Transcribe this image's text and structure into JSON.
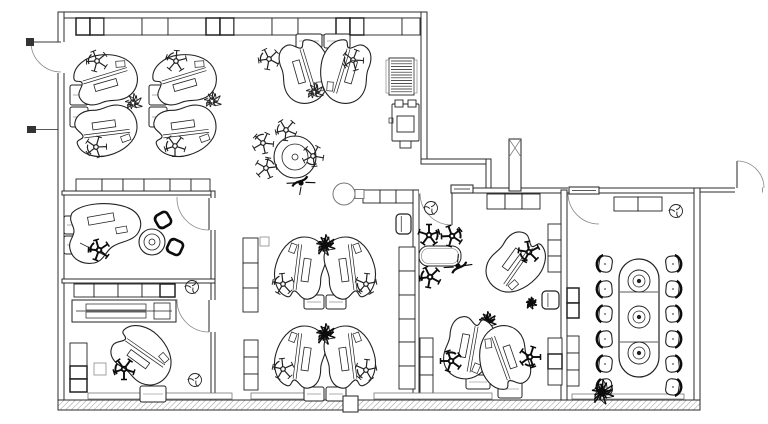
{
  "meta": {
    "width": 768,
    "height": 424,
    "bg": "#ffffff",
    "ink": "#2b2b2b",
    "furn": "#222222",
    "dark": "#0c0c0c",
    "light": "#777777"
  },
  "plan": {
    "walls": [
      {
        "x": 60,
        "y": 12,
        "w": 367,
        "h": 6
      },
      {
        "x": 58,
        "y": 12,
        "w": 6,
        "h": 398
      },
      {
        "x": 421,
        "y": 12,
        "w": 6,
        "h": 152
      },
      {
        "x": 421,
        "y": 159,
        "w": 70,
        "h": 5
      },
      {
        "x": 486,
        "y": 159,
        "w": 5,
        "h": 33
      },
      {
        "x": 449,
        "y": 188,
        "w": 251,
        "h": 5
      },
      {
        "x": 413,
        "y": 190,
        "w": 6,
        "h": 212
      },
      {
        "x": 561,
        "y": 190,
        "w": 6,
        "h": 212
      },
      {
        "x": 694,
        "y": 188,
        "w": 6,
        "h": 222
      },
      {
        "x": 58,
        "y": 400,
        "w": 642,
        "h": 10,
        "hatch": true
      },
      {
        "x": 62,
        "y": 191,
        "w": 153,
        "h": 4
      },
      {
        "x": 211,
        "y": 191,
        "w": 4,
        "h": 209
      },
      {
        "x": 62,
        "y": 279,
        "w": 153,
        "h": 4
      },
      {
        "x": 700,
        "y": 188,
        "w": 62,
        "h": 4
      }
    ],
    "gaps": [
      {
        "x": 57,
        "y": 42,
        "w": 8,
        "h": 31
      },
      {
        "x": 210,
        "y": 198,
        "w": 6,
        "h": 32
      },
      {
        "x": 210,
        "y": 300,
        "w": 6,
        "h": 32
      },
      {
        "x": 419,
        "y": 187,
        "w": 33,
        "h": 7
      },
      {
        "x": 568,
        "y": 187,
        "w": 31,
        "h": 7
      },
      {
        "x": 735,
        "y": 187,
        "w": 27,
        "h": 6
      }
    ],
    "cabinets_h": [
      {
        "x": 76,
        "y": 18,
        "h": 17,
        "w": [
          14,
          14,
          38,
          26,
          38,
          14,
          14,
          38,
          26,
          38,
          14,
          14,
          38,
          18
        ]
      },
      {
        "x": 76,
        "y": 179,
        "h": 12,
        "w": [
          26,
          21,
          21,
          26,
          21,
          19
        ]
      },
      {
        "x": 74,
        "y": 284,
        "h": 13,
        "w": [
          20,
          24,
          24,
          18,
          15
        ]
      },
      {
        "x": 363,
        "y": 190,
        "h": 13,
        "w": [
          17,
          16,
          17
        ]
      },
      {
        "x": 487,
        "y": 194,
        "h": 15,
        "w": [
          18,
          17,
          18
        ]
      },
      {
        "x": 614,
        "y": 197,
        "h": 14,
        "w": [
          24,
          24
        ]
      }
    ],
    "cabinets_v": [
      {
        "x": 243,
        "y": 238,
        "w": 15,
        "h": [
          25,
          25,
          24
        ]
      },
      {
        "x": 244,
        "y": 340,
        "w": 14,
        "h": [
          17,
          17,
          16
        ]
      },
      {
        "x": 399,
        "y": 247,
        "w": 16,
        "h": [
          24,
          24,
          24,
          23,
          24,
          23
        ]
      },
      {
        "x": 420,
        "y": 338,
        "w": 13,
        "h": [
          19,
          18,
          19
        ]
      },
      {
        "x": 548,
        "y": 224,
        "w": 13,
        "h": [
          16,
          16,
          16
        ]
      },
      {
        "x": 548,
        "y": 338,
        "w": 14,
        "h": [
          16,
          15,
          16
        ]
      },
      {
        "x": 567,
        "y": 288,
        "w": 12,
        "h": [
          15,
          15
        ]
      },
      {
        "x": 567,
        "y": 336,
        "w": 12,
        "h": [
          17,
          17,
          16
        ]
      },
      {
        "x": 70,
        "y": 343,
        "w": 17,
        "h": [
          23,
          13,
          13
        ]
      }
    ],
    "sills": [
      {
        "x": 88,
        "y": 393,
        "w": 144,
        "h": 6
      },
      {
        "x": 251,
        "y": 393,
        "w": 66,
        "h": 6
      },
      {
        "x": 374,
        "y": 393,
        "w": 118,
        "h": 6
      },
      {
        "x": 572,
        "y": 394,
        "w": 112,
        "h": 5
      }
    ],
    "doors": [
      {
        "hx": 61,
        "hy": 42,
        "r": 30,
        "a0": 180,
        "a1": 90,
        "cap": [
          26,
          38,
          8,
          8
        ]
      },
      {
        "hx": 209,
        "hy": 198,
        "r": 32,
        "a0": 90,
        "a1": 182
      },
      {
        "hx": 209,
        "hy": 300,
        "r": 32,
        "a0": 90,
        "a1": 182
      },
      {
        "hx": 452,
        "hy": 193,
        "r": 32,
        "a0": 90,
        "a1": 180,
        "crect": [
          451,
          185,
          22,
          8
        ]
      },
      {
        "hx": 599,
        "hy": 193,
        "r": 31,
        "a0": 180,
        "a1": 90,
        "crect": [
          569,
          187,
          30,
          7
        ]
      },
      {
        "hx": 737,
        "hy": 188,
        "r": 27,
        "a0": 270,
        "a1": 360
      }
    ],
    "items": [
      {
        "t": "column",
        "x": 509,
        "y": 139,
        "w": 12,
        "h": 52,
        "xx": true
      },
      {
        "t": "ped",
        "x": 70,
        "y": 85,
        "w": 18,
        "h": 20
      },
      {
        "t": "ped",
        "x": 70,
        "y": 107,
        "w": 18,
        "h": 20
      },
      {
        "t": "kidney",
        "x": 107,
        "y": 80,
        "r": -12
      },
      {
        "t": "kidney",
        "x": 107,
        "y": 129,
        "r": 12,
        "fy": true
      },
      {
        "t": "chair",
        "x": 97,
        "y": 61,
        "r": 15
      },
      {
        "t": "chair",
        "x": 96,
        "y": 147,
        "r": -20
      },
      {
        "t": "plant",
        "x": 133,
        "y": 103,
        "s": 11
      },
      {
        "t": "ped",
        "x": 149,
        "y": 85,
        "w": 18,
        "h": 20
      },
      {
        "t": "ped",
        "x": 149,
        "y": 107,
        "w": 18,
        "h": 20
      },
      {
        "t": "kidney",
        "x": 186,
        "y": 80,
        "r": -12
      },
      {
        "t": "kidney",
        "x": 186,
        "y": 129,
        "r": 12,
        "fy": true
      },
      {
        "t": "chair",
        "x": 176,
        "y": 61,
        "r": 40
      },
      {
        "t": "chair",
        "x": 175,
        "y": 146,
        "r": 0
      },
      {
        "t": "plant",
        "x": 212,
        "y": 101,
        "s": 11
      },
      {
        "t": "ped",
        "x": 296,
        "y": 34,
        "w": 26,
        "h": 14
      },
      {
        "t": "ped",
        "x": 324,
        "y": 34,
        "w": 26,
        "h": 14
      },
      {
        "t": "kidney",
        "x": 304,
        "y": 73,
        "r": 78
      },
      {
        "t": "kidney",
        "x": 346,
        "y": 73,
        "r": 78,
        "fx": true
      },
      {
        "t": "chair",
        "x": 269,
        "y": 59,
        "r": 10
      },
      {
        "t": "chair",
        "x": 353,
        "y": 60,
        "r": -15
      },
      {
        "t": "plant",
        "x": 314,
        "y": 92,
        "s": 11
      },
      {
        "t": "rtable",
        "x": 295,
        "y": 157,
        "rings": [
          21,
          13,
          3
        ]
      },
      {
        "t": "chair",
        "x": 286,
        "y": 130,
        "r": 5
      },
      {
        "t": "chair",
        "x": 263,
        "y": 143,
        "r": 60
      },
      {
        "t": "chair",
        "x": 266,
        "y": 168,
        "r": 120
      },
      {
        "t": "chair",
        "x": 313,
        "y": 156,
        "r": -80
      },
      {
        "t": "person",
        "x": 301,
        "y": 183,
        "r": -35
      },
      {
        "t": "radiator",
        "x": 389,
        "y": 58,
        "w": 25,
        "h": 37
      },
      {
        "t": "printer",
        "x": 392,
        "y": 100,
        "w": 27,
        "h": 47
      },
      {
        "t": "ped",
        "x": 64,
        "y": 216,
        "w": 13,
        "h": 18
      },
      {
        "t": "ped",
        "x": 64,
        "y": 236,
        "w": 13,
        "h": 18
      },
      {
        "t": "exec",
        "x": 64,
        "y": 203
      },
      {
        "t": "chair",
        "x": 99,
        "y": 250,
        "r": 20,
        "d": true
      },
      {
        "t": "rtable",
        "x": 152,
        "y": 242,
        "rings": [
          13,
          8,
          3
        ]
      },
      {
        "t": "vchair",
        "x": 163,
        "y": 220,
        "r": -30
      },
      {
        "t": "vchair",
        "x": 175,
        "y": 247,
        "r": 25
      },
      {
        "t": "credenza",
        "x": 72,
        "y": 300,
        "w": 104,
        "h": 22
      },
      {
        "t": "sq",
        "x": 94,
        "y": 363,
        "s": 12
      },
      {
        "t": "kidney",
        "x": 143,
        "y": 357,
        "r": 40
      },
      {
        "t": "chair",
        "x": 124,
        "y": 369,
        "r": 0,
        "d": true
      },
      {
        "t": "ped",
        "x": 140,
        "y": 386,
        "w": 26,
        "h": 16
      },
      {
        "t": "fixture",
        "x": 192,
        "y": 287
      },
      {
        "t": "fixture",
        "x": 195,
        "y": 380
      },
      {
        "t": "fixture",
        "x": 431,
        "y": 208
      },
      {
        "t": "fixture",
        "x": 676,
        "y": 211
      },
      {
        "t": "sq",
        "x": 260,
        "y": 237,
        "s": 9
      },
      {
        "t": "wcooler",
        "x": 344,
        "y": 194
      },
      {
        "t": "box",
        "x": 396,
        "y": 214,
        "w": 15,
        "h": 20
      },
      {
        "t": "ped",
        "x": 304,
        "y": 295,
        "w": 20,
        "h": 14
      },
      {
        "t": "ped",
        "x": 326,
        "y": 295,
        "w": 20,
        "h": 14
      },
      {
        "t": "kidney",
        "x": 302,
        "y": 267,
        "r": -78
      },
      {
        "t": "kidney",
        "x": 348,
        "y": 267,
        "r": -78,
        "fx": true
      },
      {
        "t": "plant",
        "x": 325,
        "y": 245,
        "s": 12,
        "d": true
      },
      {
        "t": "chair",
        "x": 283,
        "y": 284,
        "r": 30
      },
      {
        "t": "chair",
        "x": 366,
        "y": 284,
        "r": -30
      },
      {
        "t": "ped",
        "x": 304,
        "y": 387,
        "w": 20,
        "h": 14
      },
      {
        "t": "ped",
        "x": 326,
        "y": 387,
        "w": 20,
        "h": 14
      },
      {
        "t": "kidney",
        "x": 302,
        "y": 356,
        "r": -78
      },
      {
        "t": "kidney",
        "x": 348,
        "y": 356,
        "r": -78,
        "fx": true
      },
      {
        "t": "plant",
        "x": 325,
        "y": 334,
        "s": 12,
        "d": true
      },
      {
        "t": "chair",
        "x": 283,
        "y": 369,
        "r": 30
      },
      {
        "t": "chair",
        "x": 366,
        "y": 370,
        "r": -30
      },
      {
        "t": "counter",
        "x": 419,
        "y": 246,
        "w": 42,
        "h": 20
      },
      {
        "t": "chair",
        "x": 429,
        "y": 235,
        "r": 180,
        "d": true
      },
      {
        "t": "chair",
        "x": 452,
        "y": 236,
        "r": 160,
        "d": true
      },
      {
        "t": "chair",
        "x": 430,
        "y": 277,
        "r": 10,
        "d": true
      },
      {
        "t": "person",
        "x": 458,
        "y": 266,
        "r": 140
      },
      {
        "t": "kidney",
        "x": 514,
        "y": 264,
        "r": 130
      },
      {
        "t": "chair",
        "x": 529,
        "y": 252,
        "r": -45,
        "d": true
      },
      {
        "t": "plant",
        "x": 531,
        "y": 303,
        "s": 7,
        "d": true
      },
      {
        "t": "box",
        "x": 542,
        "y": 291,
        "w": 17,
        "h": 18
      },
      {
        "t": "ped",
        "x": 466,
        "y": 375,
        "w": 24,
        "h": 14
      },
      {
        "t": "ped",
        "x": 498,
        "y": 380,
        "w": 24,
        "h": 18
      },
      {
        "t": "plant",
        "x": 487,
        "y": 321,
        "s": 11,
        "d": true
      },
      {
        "t": "kidney",
        "x": 468,
        "y": 349,
        "r": 105
      },
      {
        "t": "kidney",
        "x": 505,
        "y": 356,
        "r": 255
      },
      {
        "t": "chair",
        "x": 451,
        "y": 361,
        "r": 90,
        "d": true
      },
      {
        "t": "chair",
        "x": 530,
        "y": 357,
        "r": -90,
        "d": true
      },
      {
        "t": "cchair",
        "x": 605,
        "y": 264,
        "r": 8
      },
      {
        "t": "cchair",
        "x": 605,
        "y": 289,
        "r": -5
      },
      {
        "t": "cchair",
        "x": 605,
        "y": 314,
        "r": 5
      },
      {
        "t": "cchair",
        "x": 605,
        "y": 339,
        "r": -6
      },
      {
        "t": "cchair",
        "x": 605,
        "y": 364,
        "r": 6
      },
      {
        "t": "cchair",
        "x": 605,
        "y": 387,
        "r": -8
      },
      {
        "t": "cchair",
        "x": 673,
        "y": 264,
        "r": 172
      },
      {
        "t": "cchair",
        "x": 673,
        "y": 289,
        "r": 185
      },
      {
        "t": "cchair",
        "x": 673,
        "y": 314,
        "r": 175
      },
      {
        "t": "cchair",
        "x": 673,
        "y": 339,
        "r": 186
      },
      {
        "t": "cchair",
        "x": 673,
        "y": 364,
        "r": 174
      },
      {
        "t": "cchair",
        "x": 673,
        "y": 387,
        "r": 188
      },
      {
        "t": "ctable",
        "x": 619,
        "y": 259,
        "w": 40,
        "h": 118,
        "div": [
          292,
          342
        ],
        "rings": [
          {
            "cy": 281,
            "r": [
              11,
              6,
              1.8
            ]
          },
          {
            "cy": 317,
            "r": [
              11,
              6,
              1.8
            ]
          },
          {
            "cy": 353,
            "r": [
              11,
              6,
              1.8
            ]
          }
        ]
      },
      {
        "t": "plant",
        "x": 602,
        "y": 392,
        "s": 14,
        "d": true
      },
      {
        "t": "tick",
        "x": 27,
        "y": 126,
        "w": 9,
        "h": 7
      },
      {
        "t": "column",
        "x": 343,
        "y": 396,
        "w": 15,
        "h": 16
      }
    ]
  }
}
